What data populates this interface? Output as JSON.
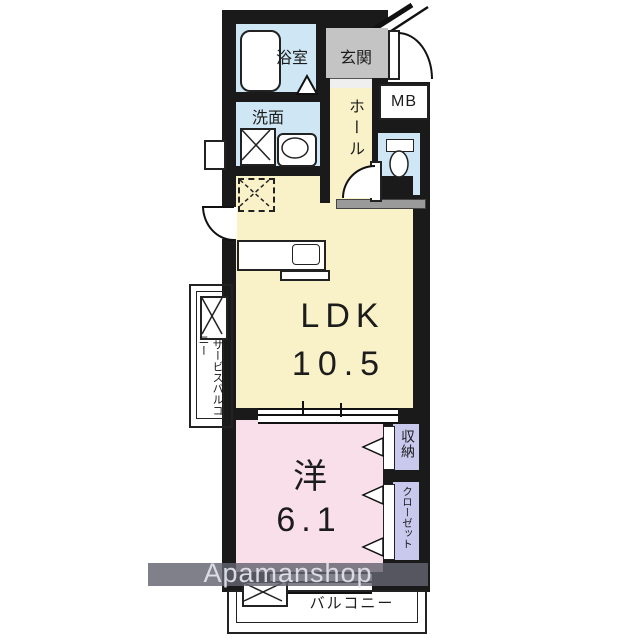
{
  "watermark": {
    "text": "Apamanshop"
  },
  "rooms": {
    "bath": {
      "label": "浴室"
    },
    "entrance": {
      "label": "玄関"
    },
    "meter_box": {
      "label": "MB"
    },
    "washroom": {
      "label": "洗面"
    },
    "hall": {
      "label": "ホール"
    },
    "toilet": {
      "label": "WC"
    },
    "ldk": {
      "label": "LDK",
      "size": "10.5"
    },
    "service_balcony": {
      "label_right": "サービス",
      "label_left": "バルコニー"
    },
    "bedroom": {
      "label": "洋",
      "size": "6.1"
    },
    "storage": {
      "label": "収納"
    },
    "closet": {
      "label": "クローゼット"
    },
    "balcony": {
      "label": "バルコニー"
    }
  },
  "colors": {
    "wall": "#1a1a1a",
    "wet_area": "#cfe7f5",
    "entrance_floor": "#c4c4c4",
    "living_floor": "#f9f2c9",
    "bedroom_floor": "#f9dfe9",
    "closet_floor": "#c9c9ee",
    "watermark_band": "#64646f"
  }
}
